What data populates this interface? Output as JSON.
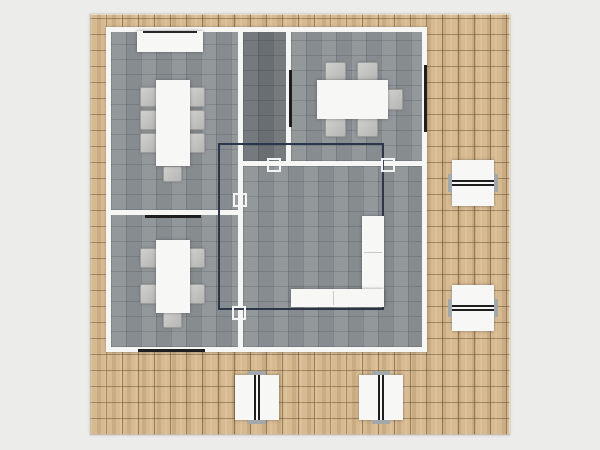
{
  "app": {
    "view": "floor-plan-top-view"
  },
  "palette": {
    "bg": "#ececea",
    "wood": "#d8ba90",
    "wall": "#f6f6f4",
    "room": "#8d9296",
    "room_dark": "#6e7377",
    "door_line": "#1e1e1e",
    "selection": "#2c364a",
    "furniture": "#f7f7f5",
    "chair": "#c2c2c1"
  },
  "canvas": {
    "width": 600,
    "height": 450
  },
  "deck": {
    "name": "wood-deck",
    "x": 90,
    "y": 14,
    "w": 420,
    "h": 421
  },
  "building": {
    "name": "building-walls",
    "x": 106,
    "y": 27,
    "w": 321,
    "h": 325
  },
  "rooms": [
    {
      "name": "room-meeting-top-left",
      "x": 111,
      "y": 32,
      "w": 127,
      "h": 178,
      "tone": "light"
    },
    {
      "name": "room-meeting-bottom-left",
      "x": 111,
      "y": 215,
      "w": 127,
      "h": 132,
      "tone": "light"
    },
    {
      "name": "room-storage-center",
      "x": 243,
      "y": 32,
      "w": 43,
      "h": 129,
      "tone": "dark"
    },
    {
      "name": "room-meeting-top-right",
      "x": 291,
      "y": 32,
      "w": 131,
      "h": 129,
      "tone": "light"
    },
    {
      "name": "room-office-large",
      "x": 243,
      "y": 166,
      "w": 179,
      "h": 181,
      "tone": "light"
    }
  ],
  "door_markers": [
    {
      "name": "door-opening-left-rooms",
      "x": 145,
      "y": 215,
      "w": 56,
      "h": 3
    },
    {
      "name": "door-opening-bottom-wall",
      "x": 138,
      "y": 349,
      "w": 67,
      "h": 3
    },
    {
      "name": "door-opening-right-wall",
      "x": 424,
      "y": 65,
      "w": 3,
      "h": 67
    },
    {
      "name": "door-opening-storage-wall",
      "x": 289,
      "y": 70,
      "w": 3,
      "h": 57
    }
  ],
  "door_symbols": [
    {
      "name": "door-symbol-center-left",
      "x": 267,
      "y": 158,
      "s": 14
    },
    {
      "name": "door-symbol-center-right",
      "x": 381,
      "y": 158,
      "s": 14
    },
    {
      "name": "door-symbol-left-wall",
      "x": 233,
      "y": 193,
      "s": 14
    },
    {
      "name": "door-symbol-left-wall-low",
      "x": 232,
      "y": 306,
      "s": 14
    }
  ],
  "selection": {
    "name": "selection-outline",
    "x": 218,
    "y": 143,
    "w": 166,
    "h": 167
  },
  "furniture": {
    "chairs": [
      {
        "x": 140,
        "y": 87,
        "w": 17,
        "h": 20
      },
      {
        "x": 140,
        "y": 110,
        "w": 17,
        "h": 20
      },
      {
        "x": 140,
        "y": 133,
        "w": 17,
        "h": 20
      },
      {
        "x": 188,
        "y": 87,
        "w": 17,
        "h": 20
      },
      {
        "x": 188,
        "y": 110,
        "w": 17,
        "h": 20
      },
      {
        "x": 188,
        "y": 133,
        "w": 17,
        "h": 20
      },
      {
        "x": 163,
        "y": 166,
        "w": 19,
        "h": 16
      },
      {
        "x": 140,
        "y": 248,
        "w": 17,
        "h": 20
      },
      {
        "x": 140,
        "y": 284,
        "w": 17,
        "h": 20
      },
      {
        "x": 188,
        "y": 248,
        "w": 17,
        "h": 20
      },
      {
        "x": 188,
        "y": 284,
        "w": 17,
        "h": 20
      },
      {
        "x": 163,
        "y": 312,
        "w": 19,
        "h": 16
      },
      {
        "x": 325,
        "y": 62,
        "w": 21,
        "h": 19
      },
      {
        "x": 357,
        "y": 62,
        "w": 21,
        "h": 19
      },
      {
        "x": 325,
        "y": 118,
        "w": 21,
        "h": 19
      },
      {
        "x": 357,
        "y": 118,
        "w": 21,
        "h": 19
      },
      {
        "x": 387,
        "y": 89,
        "w": 16,
        "h": 21
      }
    ],
    "tables": [
      {
        "name": "conference-table-top-left",
        "x": 156,
        "y": 80,
        "w": 34,
        "h": 86
      },
      {
        "name": "meeting-table-bottom-left",
        "x": 156,
        "y": 240,
        "w": 34,
        "h": 73
      },
      {
        "name": "meeting-table-top-right",
        "x": 317,
        "y": 80,
        "w": 71,
        "h": 39
      }
    ],
    "credenza": {
      "name": "credenza-sideboard",
      "x": 137,
      "y": 31,
      "w": 66,
      "h": 21
    },
    "l_desk": {
      "name": "l-shaped-desk",
      "x": 291,
      "y": 216,
      "w": 93,
      "h": 91,
      "vx": 71,
      "vw": 22,
      "hy": 73,
      "hh": 18
    },
    "desk_pairs": [
      {
        "name": "double-desk-right-upper",
        "x": 452,
        "y": 160,
        "w": 42,
        "h": 46,
        "orient": "h"
      },
      {
        "name": "double-desk-right-lower",
        "x": 452,
        "y": 285,
        "w": 42,
        "h": 46,
        "orient": "h"
      },
      {
        "name": "double-desk-bottom-left",
        "x": 235,
        "y": 375,
        "w": 44,
        "h": 45,
        "orient": "v"
      },
      {
        "name": "double-desk-bottom-right",
        "x": 359,
        "y": 375,
        "w": 44,
        "h": 45,
        "orient": "v"
      }
    ]
  }
}
